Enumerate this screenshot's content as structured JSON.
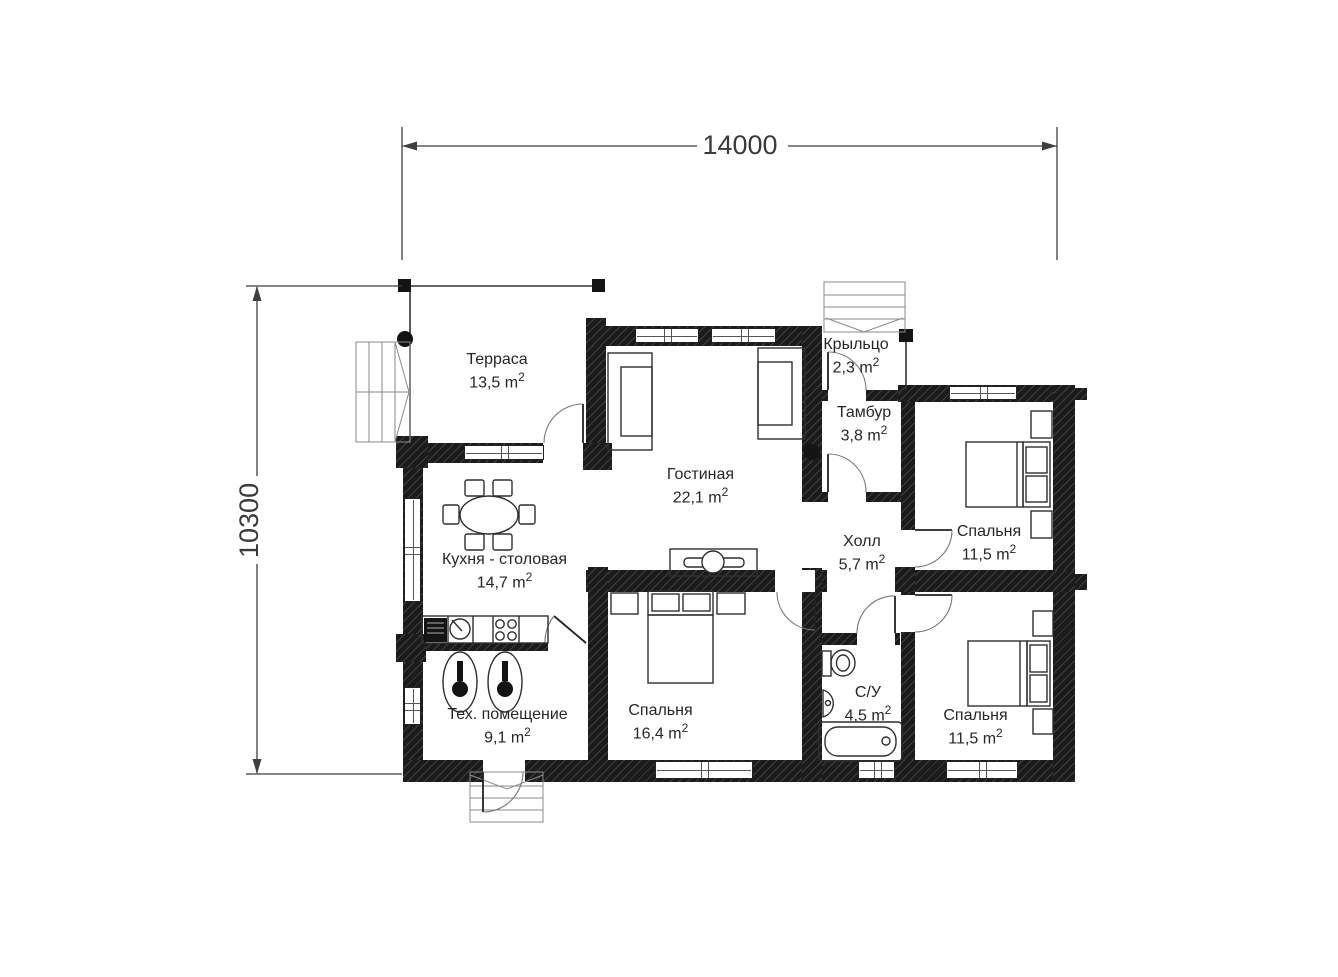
{
  "plan": {
    "dim_width": "14000",
    "dim_height": "10300",
    "unit": "m",
    "unit_sup": "2",
    "colors": {
      "wall": "#1b1b1b",
      "background": "#ffffff",
      "text": "#262626"
    },
    "rooms": {
      "terrace": {
        "name": "Терраса",
        "area": "13,5"
      },
      "porch": {
        "name": "Крыльцо",
        "area": "2,3"
      },
      "tambour": {
        "name": "Тамбур",
        "area": "3,8"
      },
      "living": {
        "name": "Гостиная",
        "area": "22,1"
      },
      "hall": {
        "name": "Холл",
        "area": "5,7"
      },
      "bedroom_ne": {
        "name": "Спальня",
        "area": "11,5"
      },
      "kitchen": {
        "name": "Кухня - столовая",
        "area": "14,7"
      },
      "bedroom_mid": {
        "name": "Спальня",
        "area": "16,4"
      },
      "bathroom": {
        "name": "С/У",
        "area": "4,5"
      },
      "bedroom_se": {
        "name": "Спальня",
        "area": "11,5"
      },
      "tech": {
        "name": "Тех. помещение",
        "area": "9,1"
      }
    }
  }
}
